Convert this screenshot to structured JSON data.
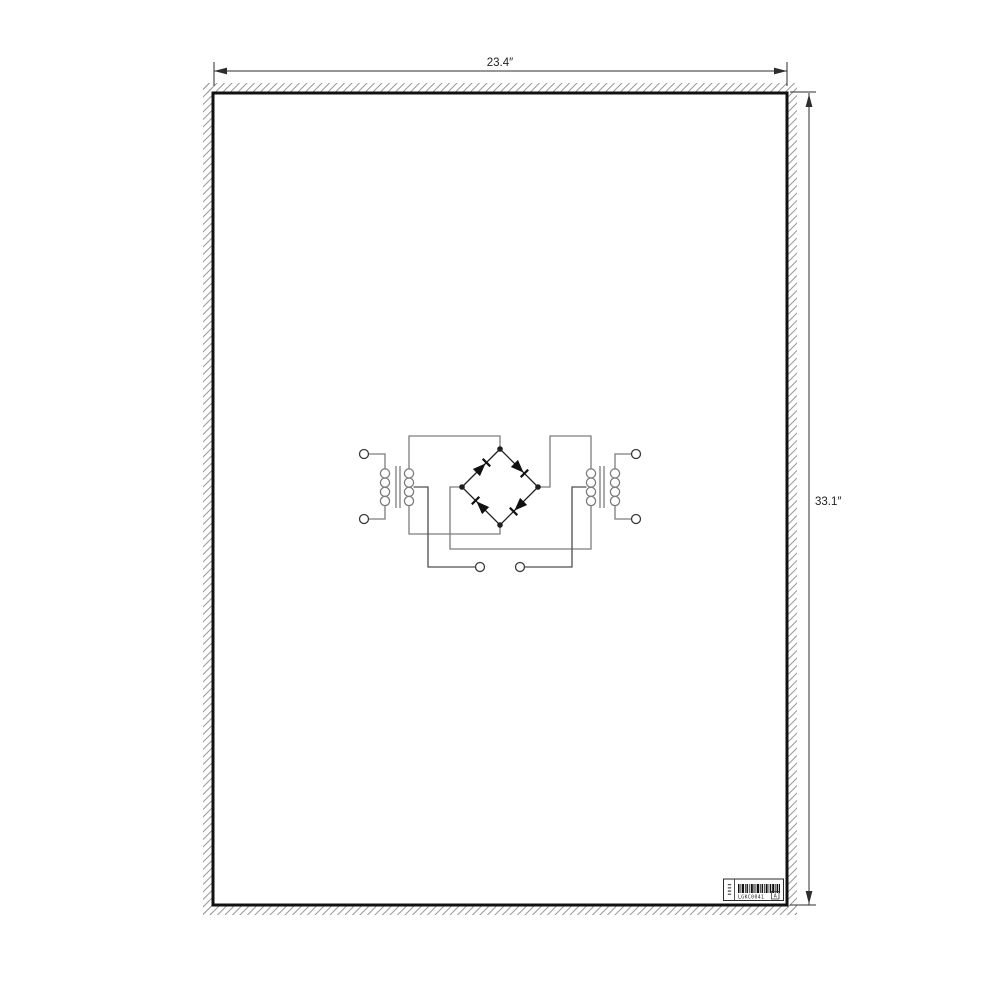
{
  "page": {
    "background": "#ffffff"
  },
  "dimensions": {
    "width_label": "23.4″",
    "height_label": "33.1″",
    "line_color": "#2e2e2e"
  },
  "sheet": {
    "border_color": "#111111",
    "fill": "#ffffff",
    "hatch_color": "#9a9a9a"
  },
  "schematic": {
    "kind": "dual-transformer-bridge-rectifier",
    "components": [
      {
        "name": "left-transformer",
        "windings": 2,
        "loops_per_winding": 4,
        "center_tapped": true
      },
      {
        "name": "diode-bridge",
        "diodes": 4
      },
      {
        "name": "right-transformer",
        "windings": 2,
        "loops_per_winding": 4,
        "center_tapped": true
      }
    ],
    "terminals": {
      "left": 2,
      "right": 2,
      "bottom": 2
    },
    "colors": {
      "wire": "#7d7d7d",
      "lead": "#4f4f4f",
      "bridge": "#1f1f1f",
      "terminal": "#3a3a3a"
    }
  },
  "label": {
    "code": "LGKC0041",
    "box_char": "A",
    "border_color": "#2a2a2a"
  }
}
